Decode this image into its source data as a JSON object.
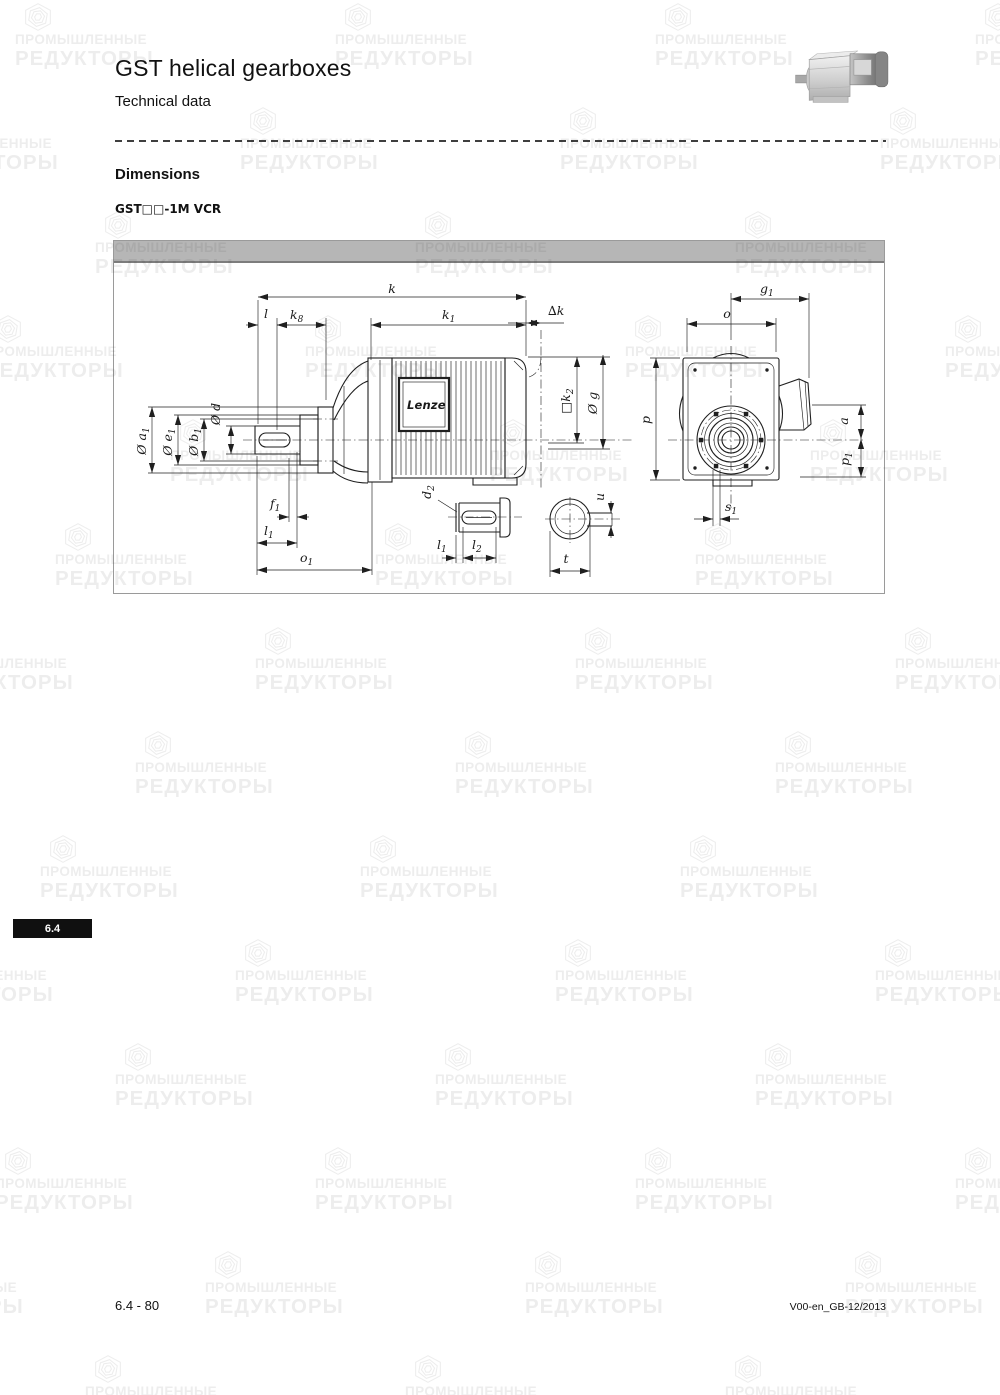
{
  "page": {
    "title": "GST helical gearboxes",
    "subtitle": "Technical data",
    "section_heading": "Dimensions",
    "model_label": "GST□□-1M VCR",
    "tab_label": "6.4",
    "footer_left": "6.4 - 80",
    "footer_right": "V00-en_GB-12/2013"
  },
  "watermark": {
    "line1": "ПРОМЫШЛЕННЫЕ",
    "line2": "РЕДУКТОРЫ"
  },
  "drawing": {
    "brand": "Lenze",
    "labels": {
      "k": {
        "base": "k"
      },
      "l": {
        "base": "l"
      },
      "k8": {
        "base": "k",
        "sub": "8"
      },
      "k1": {
        "base": "k",
        "sub": "1"
      },
      "dk": {
        "base": "∆k"
      },
      "a1": {
        "base": "Ø a",
        "sub": "1"
      },
      "e1": {
        "base": "Ø e",
        "sub": "1"
      },
      "b1": {
        "base": "Ø b",
        "sub": "1"
      },
      "d": {
        "base": "Ø d"
      },
      "f1": {
        "base": "f",
        "sub": "1"
      },
      "l1": {
        "base": "l",
        "sub": "1"
      },
      "o1": {
        "base": "o",
        "sub": "1"
      },
      "k2": {
        "base": "□k",
        "sub": "2"
      },
      "g": {
        "base": "Ø g"
      },
      "g1": {
        "base": "g",
        "sub": "1"
      },
      "o": {
        "base": "o"
      },
      "p": {
        "base": "p"
      },
      "a": {
        "base": "a"
      },
      "p1": {
        "base": "p",
        "sub": "1"
      },
      "s1": {
        "base": "s",
        "sub": "1"
      },
      "d2": {
        "base": "d",
        "sub": "2"
      },
      "l2": {
        "base": "l",
        "sub": "2"
      },
      "t": {
        "base": "t"
      },
      "u": {
        "base": "u"
      }
    }
  },
  "colors": {
    "drawing_bar": "#b6b6b6",
    "tab_bg": "#101010",
    "line": "#1f1f1f",
    "watermark_text": "rgba(45,45,45,0.085)"
  }
}
